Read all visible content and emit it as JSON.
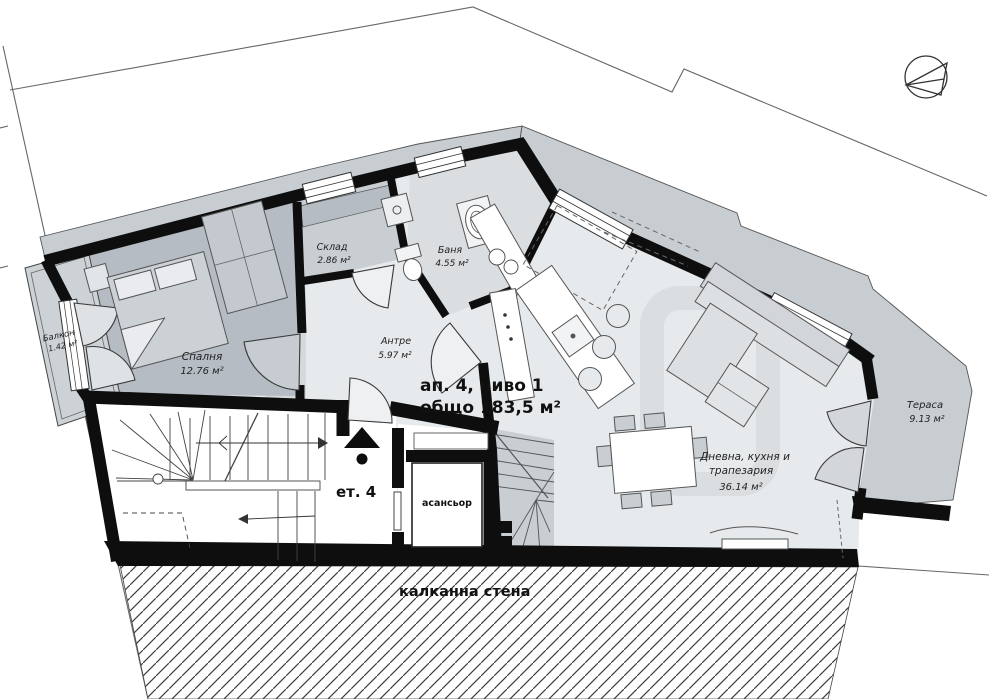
{
  "plan": {
    "title": {
      "line1": "ап. 4, ниво 1",
      "line2": "общо 183,5 м²"
    },
    "floor_marker": "ет. 4",
    "elevator_label": "асансьор",
    "firewall_label": "калканна стена",
    "rooms": {
      "bedroom": {
        "name": "Спалня",
        "area": "12.76 м²"
      },
      "balcony": {
        "name": "Балкон",
        "area": "1.42 м²"
      },
      "storage": {
        "name": "Склад",
        "area": "2.86 м²"
      },
      "bathroom": {
        "name": "Баня",
        "area": "4.55 м²"
      },
      "hallway": {
        "name": "Антре",
        "area": "5.97 м²"
      },
      "living": {
        "name_line1": "Дневна, кухня и",
        "name_line2": "трапезария",
        "area": "36.14 м²"
      },
      "terrace": {
        "name": "Тераса",
        "area": "9.13 м²"
      }
    },
    "icons": {
      "north_arrow": "north-arrow"
    },
    "colors": {
      "wall": "#0e0e0e",
      "floor_light": "#e7eaec",
      "floor_bedroom": "#b6bcc3",
      "floor_storage": "#c9ced3",
      "floor_bath": "#dbdee1",
      "floor_terrace": "#c8cdd2",
      "floor_balcony": "#cdd2d6",
      "furniture_fill": "#d2d6da",
      "outline": "#444444",
      "boundary": "#666666",
      "hatch_line": "#3c3c3c"
    }
  }
}
